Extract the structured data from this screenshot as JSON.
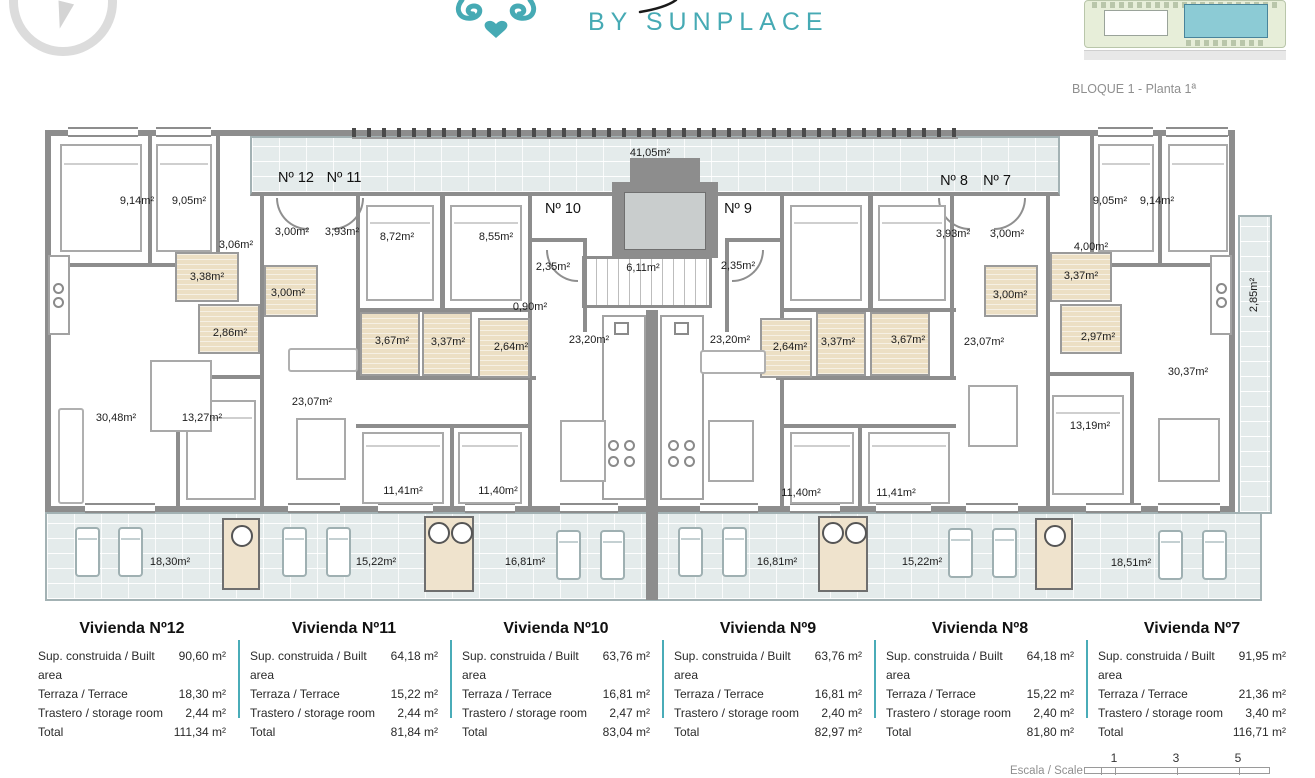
{
  "header": {
    "brand": "BY SUNPLACE",
    "block_caption": "BLOQUE 1 - Planta 1ª"
  },
  "plan": {
    "units": [
      "Nº 12",
      "Nº 11",
      "Nº 10",
      "Nº 9",
      "Nº 8",
      "Nº 7"
    ],
    "rooms": [
      {
        "name": "bedroom-apt12-a",
        "text": "9,14m²"
      },
      {
        "name": "bedroom-apt12-b",
        "text": "9,05m²"
      },
      {
        "name": "hall-apt12",
        "text": "3,06m²"
      },
      {
        "name": "entry-apt12",
        "text": "3,00m²"
      },
      {
        "name": "entry-apt11",
        "text": "3,93m²"
      },
      {
        "name": "bath-apt12-a",
        "text": "3,38m²"
      },
      {
        "name": "bath-apt12-b",
        "text": "2,86m²"
      },
      {
        "name": "bath-apt11-a",
        "text": "3,00m²"
      },
      {
        "name": "living-apt12",
        "text": "30,48m²"
      },
      {
        "name": "bedroom-apt12-c",
        "text": "13,27m²"
      },
      {
        "name": "living-apt11",
        "text": "23,07m²"
      },
      {
        "name": "bedroom-apt11-a",
        "text": "8,72m²"
      },
      {
        "name": "bedroom-apt11-b",
        "text": "8,55m²"
      },
      {
        "name": "entry-apt10",
        "text": "2,35m²"
      },
      {
        "name": "closet-apt10",
        "text": "0,90m²"
      },
      {
        "name": "bath-apt11-b",
        "text": "3,67m²"
      },
      {
        "name": "bath-apt10-a",
        "text": "3,37m²"
      },
      {
        "name": "bath-apt10-b",
        "text": "2,64m²"
      },
      {
        "name": "access-corridor",
        "text": "41,05m²"
      },
      {
        "name": "stairs",
        "text": "6,11m²"
      },
      {
        "name": "living-apt10",
        "text": "23,20m²"
      },
      {
        "name": "living-apt9",
        "text": "23,20m²"
      },
      {
        "name": "bedroom-apt11-c",
        "text": "11,41m²"
      },
      {
        "name": "bedroom-apt10-c",
        "text": "11,40m²"
      },
      {
        "name": "entry-apt9",
        "text": "2,35m²"
      },
      {
        "name": "bath-apt9-a",
        "text": "2,64m²"
      },
      {
        "name": "bath-apt9-b",
        "text": "3,37m²"
      },
      {
        "name": "bath-apt8-a",
        "text": "3,67m²"
      },
      {
        "name": "living-apt8",
        "text": "23,07m²"
      },
      {
        "name": "entry-apt8",
        "text": "3,93m²"
      },
      {
        "name": "entry-apt7",
        "text": "3,00m²"
      },
      {
        "name": "bath-apt8-b",
        "text": "3,00m²"
      },
      {
        "name": "hall-apt7",
        "text": "4,00m²"
      },
      {
        "name": "bath-apt7-a",
        "text": "3,37m²"
      },
      {
        "name": "bath-apt7-b",
        "text": "2,97m²"
      },
      {
        "name": "bedroom-apt7-a",
        "text": "9,05m²"
      },
      {
        "name": "bedroom-apt7-b",
        "text": "9,14m²"
      },
      {
        "name": "living-apt7",
        "text": "30,37m²"
      },
      {
        "name": "bedroom-apt7-c",
        "text": "13,19m²"
      },
      {
        "name": "bedroom-apt9-c",
        "text": "11,40m²"
      },
      {
        "name": "bedroom-apt8-c",
        "text": "11,41m²"
      },
      {
        "name": "terrace-apt12",
        "text": "18,30m²"
      },
      {
        "name": "terrace-apt11",
        "text": "15,22m²"
      },
      {
        "name": "terrace-apt10",
        "text": "16,81m²"
      },
      {
        "name": "terrace-apt9",
        "text": "16,81m²"
      },
      {
        "name": "terrace-apt8",
        "text": "15,22m²"
      },
      {
        "name": "terrace-apt7",
        "text": "18,51m²"
      },
      {
        "name": "side-terrace-apt7",
        "text": "2,85m²"
      }
    ]
  },
  "legend": {
    "row_labels": {
      "built": "Sup. construida / Built area",
      "terrace": "Terraza / Terrace",
      "storage": "Trastero / storage room",
      "total": "Total"
    },
    "units": [
      {
        "title": "Vivienda Nº12",
        "built": "90,60 m²",
        "terrace": "18,30 m²",
        "storage": "2,44 m²",
        "total": "111,34 m²"
      },
      {
        "title": "Vivienda Nº11",
        "built": "64,18 m²",
        "terrace": "15,22 m²",
        "storage": "2,44 m²",
        "total": "81,84 m²"
      },
      {
        "title": "Vivienda Nº10",
        "built": "63,76 m²",
        "terrace": "16,81 m²",
        "storage": "2,47 m²",
        "total": "83,04 m²"
      },
      {
        "title": "Vivienda Nº9",
        "built": "63,76 m²",
        "terrace": "16,81 m²",
        "storage": "2,40 m²",
        "total": "82,97 m²"
      },
      {
        "title": "Vivienda Nº8",
        "built": "64,18 m²",
        "terrace": "15,22 m²",
        "storage": "2,40 m²",
        "total": "81,80 m²"
      },
      {
        "title": "Vivienda Nº7",
        "built": "91,95 m²",
        "terrace": "21,36 m²",
        "storage": "3,40 m²",
        "total": "116,71 m²"
      }
    ]
  },
  "scale": {
    "label": "Escala / Scale",
    "ticks": [
      "1",
      "3",
      "5"
    ]
  },
  "colors": {
    "accent_teal": "#46aab4",
    "wall_gray": "#8d8d8d",
    "terrace_blue": "#e4ebeb",
    "bath_beige": "#ecdfc4",
    "site_building_teal": "#8ccbd5"
  }
}
